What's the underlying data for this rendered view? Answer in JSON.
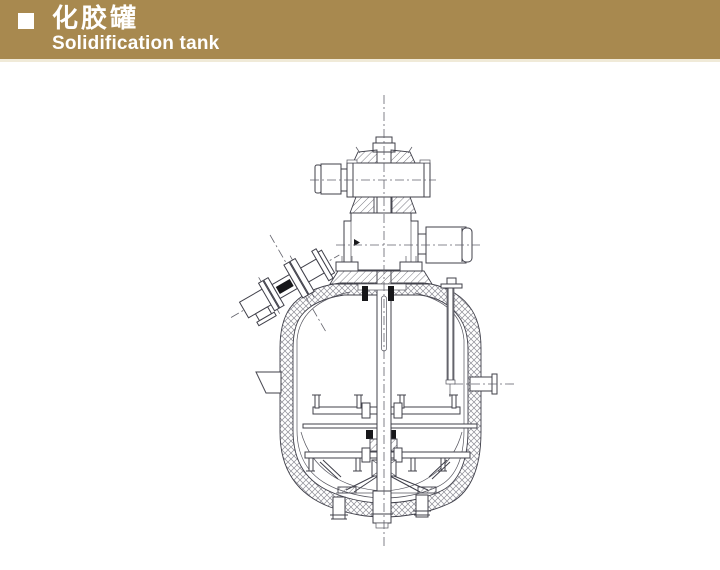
{
  "header": {
    "bullet_icon": "square-bullet-icon",
    "title_zh": "化胶罐",
    "title_en": "Solidification tank",
    "colors": {
      "banner_bg": "#a8894f",
      "banner_text": "#ffffff",
      "banner_underline": "#f0ead8"
    }
  },
  "drawing": {
    "type": "technical-sectional-diagram",
    "subject": "solidification tank with top-entry agitator",
    "line_color": "#40404a",
    "hatch_color": "#8d8d96",
    "background": "#ffffff"
  }
}
